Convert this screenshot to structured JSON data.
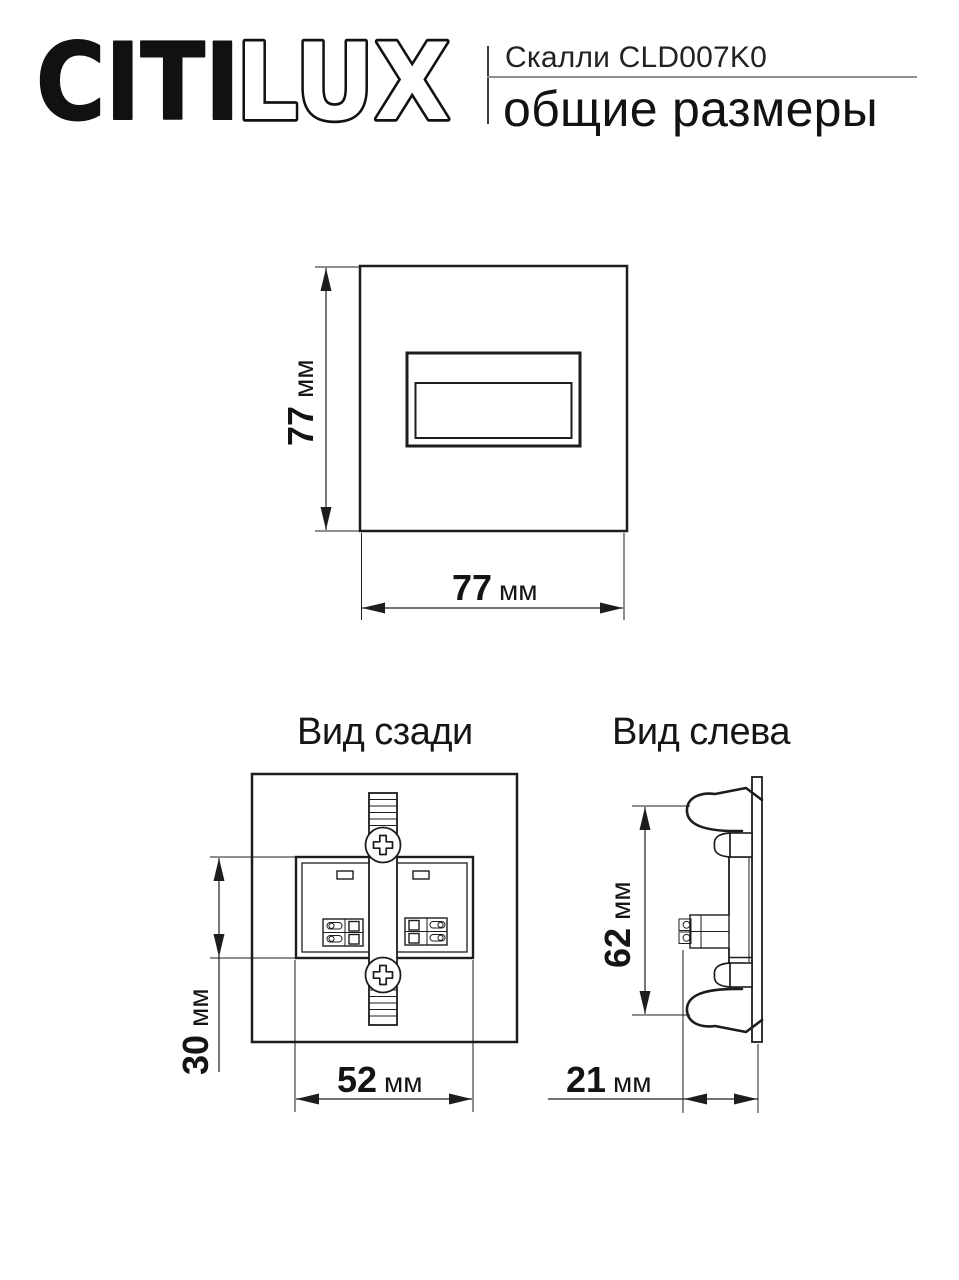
{
  "header": {
    "brand_citi": "CITI",
    "brand_lux": "LUX",
    "product": "Скалли CLD007K0",
    "subtitle": "общие размеры"
  },
  "colors": {
    "ink": "#1a1a1a",
    "rule_gray": "#909090",
    "background": "#ffffff"
  },
  "views": {
    "front": {
      "height": {
        "value": "77",
        "unit": "мм"
      },
      "width": {
        "value": "77",
        "unit": "мм"
      }
    },
    "rear": {
      "title": "Вид сзади",
      "height": {
        "value": "30",
        "unit": "мм"
      },
      "width": {
        "value": "52",
        "unit": "мм"
      }
    },
    "left": {
      "title": "Вид слева",
      "height": {
        "value": "62",
        "unit": "мм"
      },
      "depth": {
        "value": "21",
        "unit": "мм"
      }
    }
  }
}
